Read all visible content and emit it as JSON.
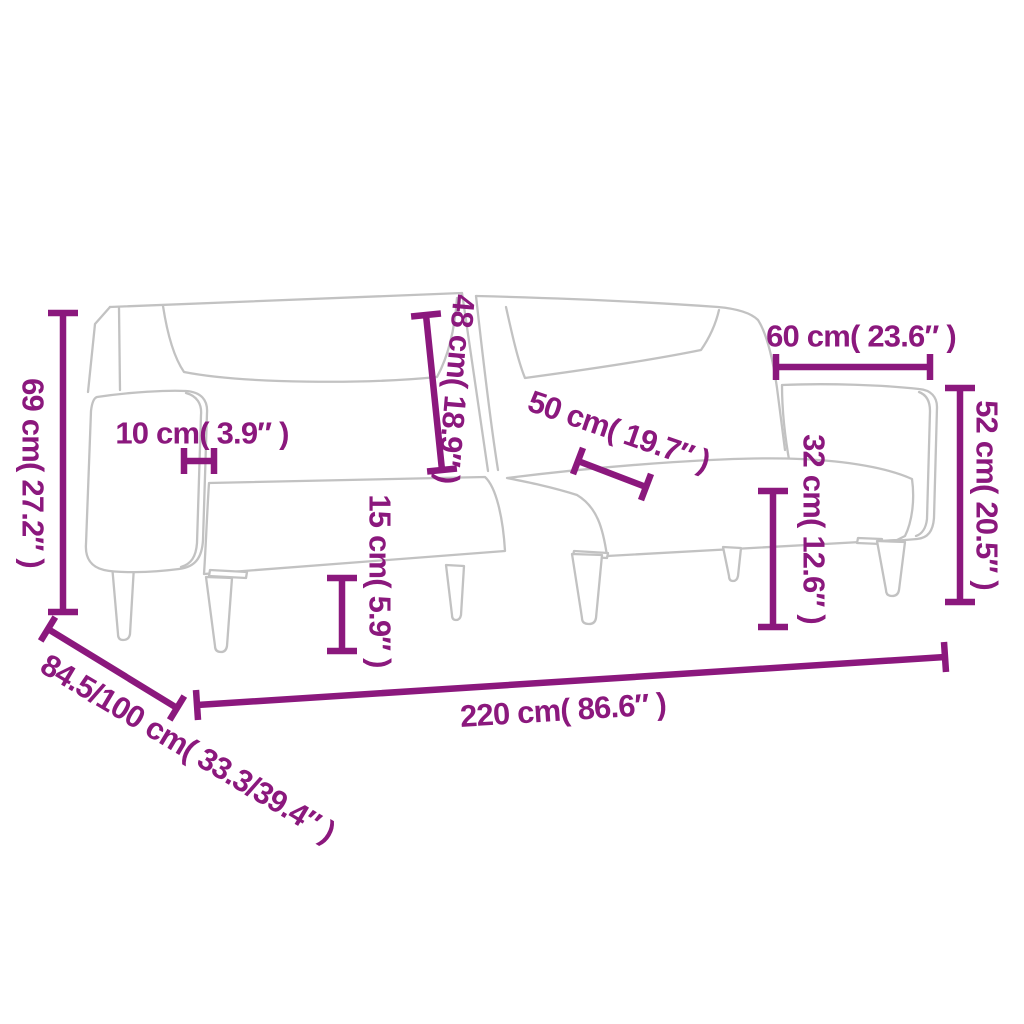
{
  "canvas": {
    "width": 1024,
    "height": 1024,
    "background": "#ffffff"
  },
  "diagram": {
    "kind": "product-dimension-diagram",
    "subject": "two-seater sofa bed line drawing with armrest, split backrest, folded-down right backrest panel and six tapered legs",
    "outline_color": "#c2c2c2",
    "dimension_color": "#8b187d"
  },
  "dimensions": [
    {
      "id": "overall-height",
      "cm": "69",
      "inch": "27.2",
      "label": "69 cm( 27.2″ )",
      "orientation": "vertical"
    },
    {
      "id": "armrest-width",
      "cm": "10",
      "inch": "3.9",
      "label": "10 cm( 3.9″ )",
      "orientation": "horizontal"
    },
    {
      "id": "backrest-height",
      "cm": "48",
      "inch": "18.9",
      "label": "48 cm( 18.9″ )",
      "orientation": "vertical"
    },
    {
      "id": "seat-depth",
      "cm": "50",
      "inch": "19.7",
      "label": "50 cm( 19.7″ )",
      "orientation": "diagonal"
    },
    {
      "id": "right-section-width",
      "cm": "60",
      "inch": "23.6",
      "label": "60 cm( 23.6″ )",
      "orientation": "horizontal"
    },
    {
      "id": "right-backrest-height",
      "cm": "52",
      "inch": "20.5",
      "label": "52 cm( 20.5″ )",
      "orientation": "vertical"
    },
    {
      "id": "seat-height",
      "cm": "32",
      "inch": "12.6",
      "label": "32 cm( 12.6″ )",
      "orientation": "vertical"
    },
    {
      "id": "leg-height",
      "cm": "15",
      "inch": "5.9",
      "label": "15 cm( 5.9″ )",
      "orientation": "vertical"
    },
    {
      "id": "overall-width",
      "cm": "220",
      "inch": "86.6",
      "label": "220 cm( 86.6″ )",
      "orientation": "horizontal"
    },
    {
      "id": "depth-range",
      "cm": "84.5/100",
      "inch": "33.3/39.4",
      "label": "84.5/100 cm( 33.3/39.4″ )",
      "orientation": "diagonal"
    }
  ]
}
